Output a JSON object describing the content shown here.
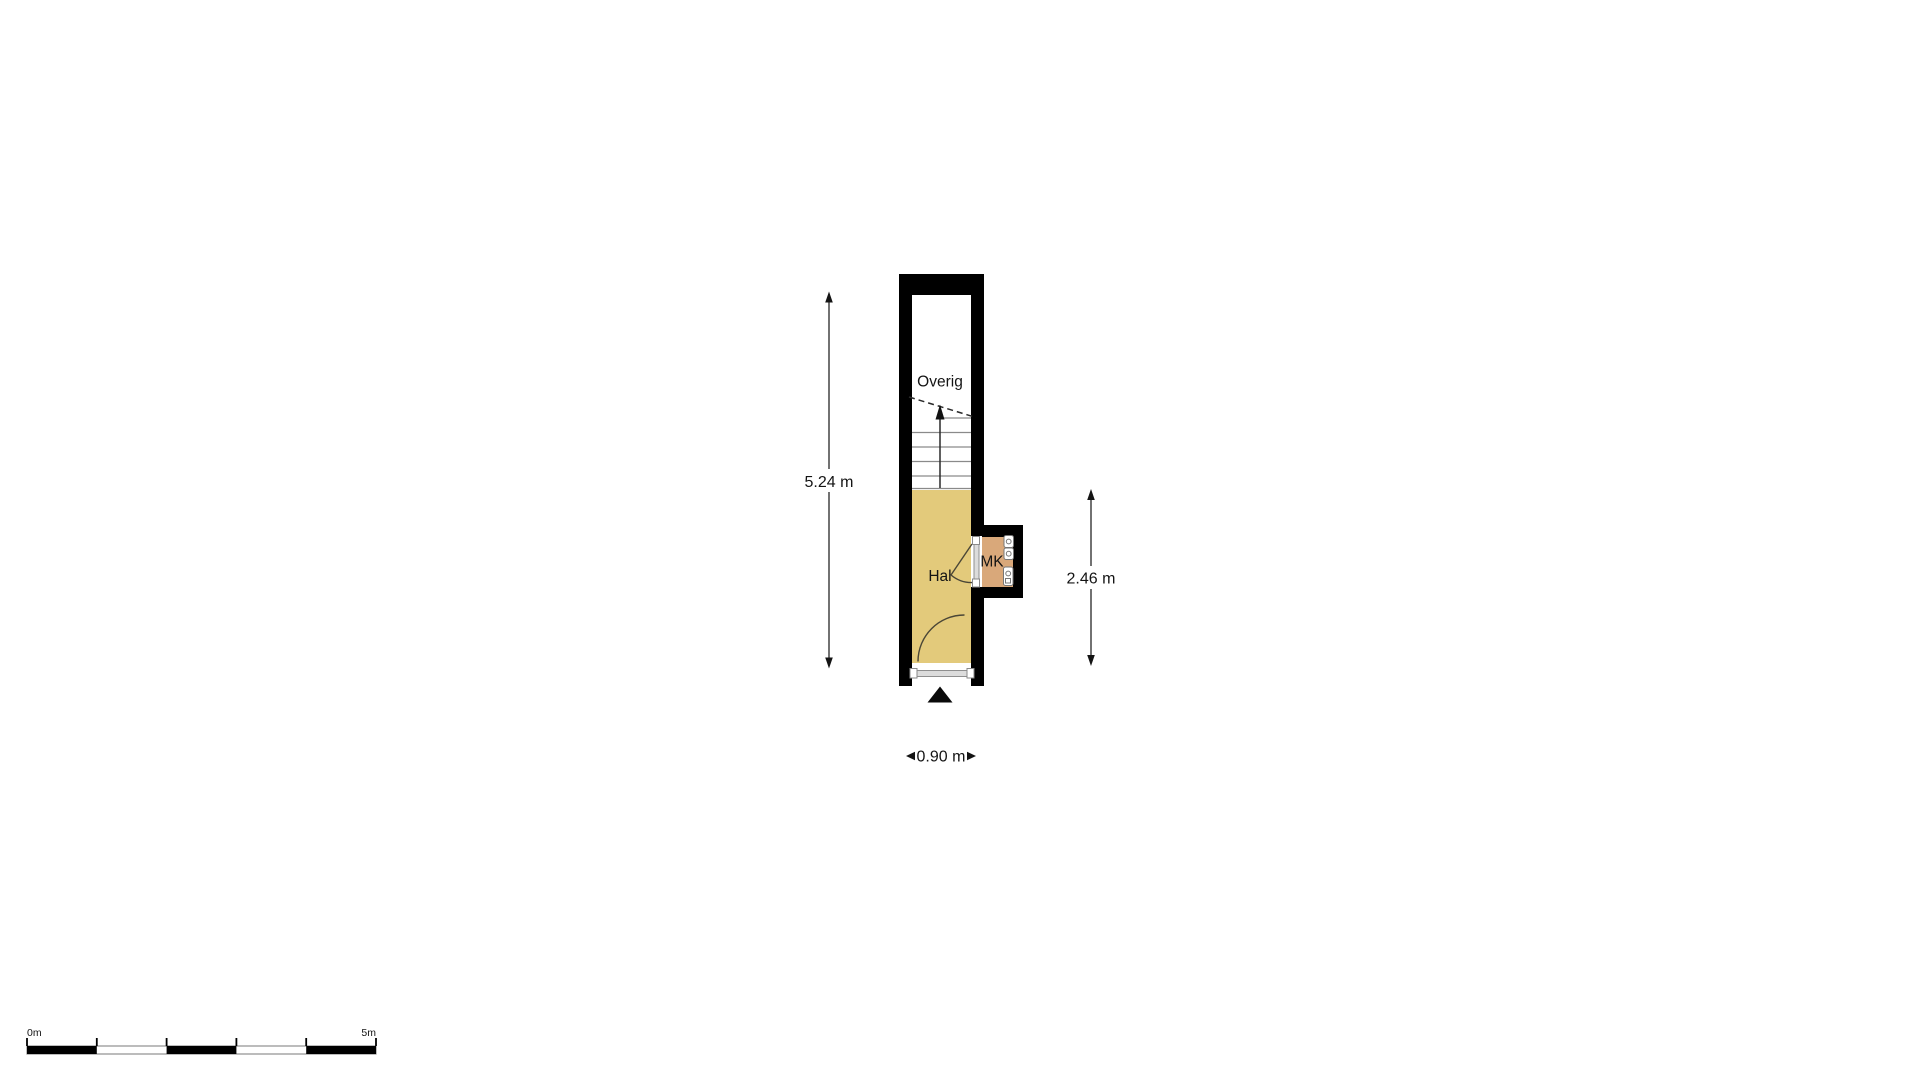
{
  "floorplan": {
    "rooms": [
      {
        "name": "Overig",
        "fill": "#ffffff"
      },
      {
        "name": "Hal",
        "fill": "#e3ca7b"
      },
      {
        "name": "MK",
        "fill": "#d9a87a"
      }
    ],
    "stairs": {
      "direction": "up",
      "treads": 6
    },
    "dimensions": {
      "total_height": "5.24 m",
      "hal_height": "2.46 m",
      "width": "0.90 m"
    },
    "scale_bar": {
      "start_label": "0m",
      "end_label": "5m",
      "segments": 5
    },
    "colors": {
      "wall": "#000000",
      "hal_fill": "#e3ca7b",
      "mk_fill": "#d9a87a",
      "door_fill": "#dcdcdc",
      "door_edge": "#8f8f8f",
      "tread_line": "#8a8a8a",
      "annotation": "#141414"
    }
  }
}
